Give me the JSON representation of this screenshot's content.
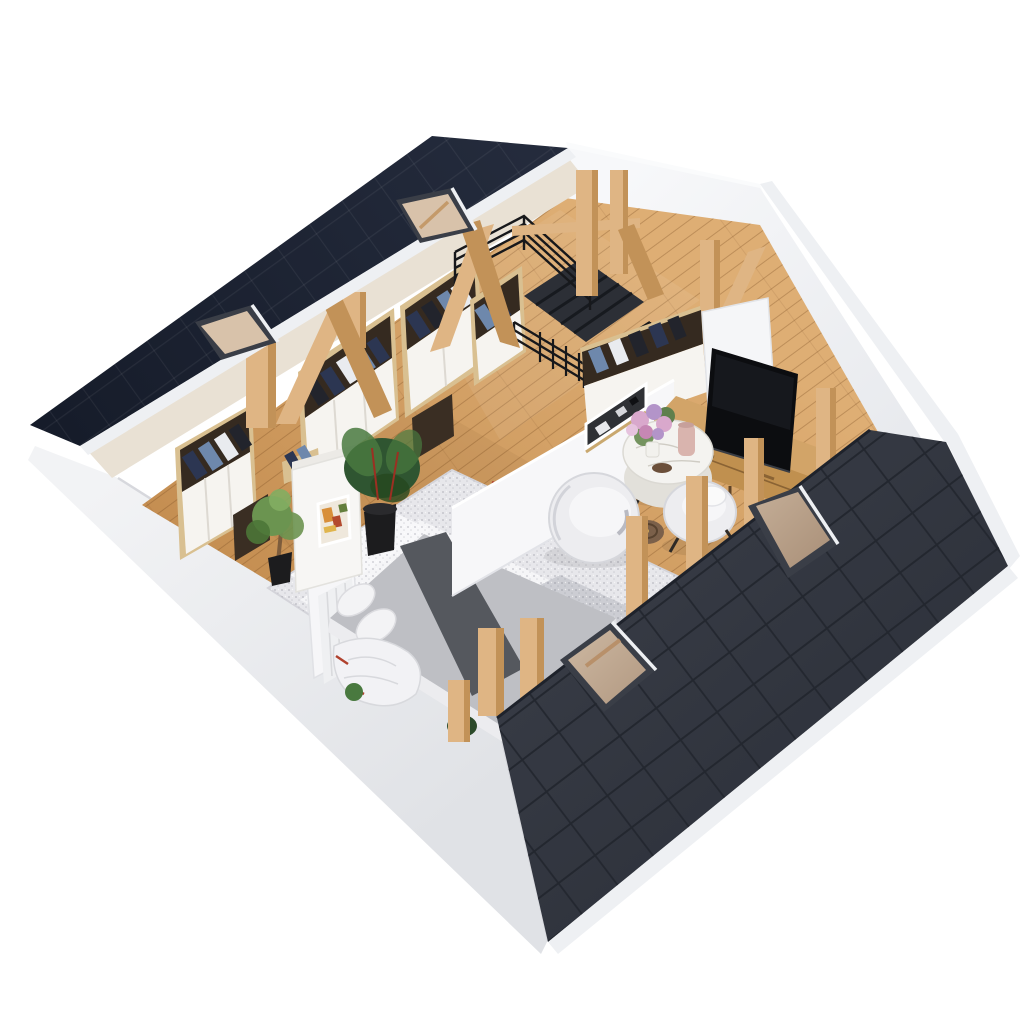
{
  "scene": {
    "label": "3D isometric attic floor plan render with open bedroom and living area under a dark tiled roof",
    "background": "#ffffff"
  },
  "items": {
    "roofs": [
      "upper-tiled-roof",
      "lower-tiled-roof"
    ],
    "upper_roof_skylights": 2,
    "lower_roof_skylights": 2,
    "structure": [
      "exposed-wood-posts",
      "diagonal-braces",
      "white-cut-walls",
      "oak-plank-floor"
    ],
    "stair_landing": [
      "stair-opening",
      "black-metal-railing",
      "stair-treads"
    ],
    "bedroom": [
      "double-bed",
      "gray-duvet",
      "dark-bed-runner",
      "pillows",
      "area-rug",
      "headboard",
      "wardrobes-with-clothes",
      "decor-cabinet-with-artwork",
      "potted-plants"
    ],
    "living_area": [
      "tv",
      "wood-media-console",
      "round-marble-coffee-table",
      "flower-bouquet",
      "pink-vase",
      "swivel-lounge-chair",
      "tub-chair",
      "brown-side-table",
      "room-divider-with-art",
      "open-closet-with-clothes"
    ]
  },
  "palette": {
    "bg": "#ffffff",
    "roofTopA": "#242b3c",
    "roofTopB": "#161c2a",
    "roofTileLine": "rgba(255,255,255,0.06)",
    "roofLowA": "#3a3e48",
    "roofLowB": "#2a2e37",
    "roofLowLine": "#23272f",
    "ridgeLine": "#1e222b",
    "fascia": "#eef0f3",
    "wallBright": "#f5f6f8",
    "wallFace": "#eceef1",
    "wallShade": "#dfe1e6",
    "bandEdge": "#d7d8dd",
    "underRoof": "#e9e1d4",
    "floorA": "#dcab71",
    "floorB": "#bf8547",
    "plank": "rgba(122,76,34,0.33)",
    "beamFace": "#dfb584",
    "beamSide": "#c29258",
    "beamTop": "#f1d8a8",
    "stairPit": "#2c2f36",
    "tread": "#171a1f",
    "rail": "#17181b",
    "wardWood": "#d9c091",
    "wardWoodSide": "#bb8f59",
    "wardWhite": "#f6f4f0",
    "wardSeam": "#ddd9d2",
    "interiorDark": "#352a20",
    "gNavy": "#2c3652",
    "gBlue": "#6e88ac",
    "gWhite": "#e9ebef",
    "gBlack": "#22242c",
    "cabinetDark": "#3a2e23",
    "rugBase": "#e7e7eb",
    "rugLight": "#f6f6f8",
    "rugDark": "#c7c8cf",
    "rugEdge": "#d5d6dc",
    "duvet": "#bebfc4",
    "runner": "#55585e",
    "pillow": "#f3f3f5",
    "mattress": "#ececef",
    "mattressShade": "#e0e1e5",
    "headboard": "#f6f6f8",
    "stripe": "#d9dadd",
    "throw": "#f2f2f5",
    "accentRed": "#b0412e",
    "plantDark": "#2f5531",
    "plantLight": "#49793f",
    "plantPot": "#1c1c1e",
    "treeGreen": "#6b9450",
    "trunk": "#7d5c3c",
    "artBg": "#efe8dc",
    "artOrange": "#d88f3a",
    "artRed": "#b34a2e",
    "artGreen": "#647f3e",
    "artYellow": "#e0b54d",
    "dividerWhite": "#f7f7f9",
    "frameDark": "#2f3135",
    "frameWhite": "#ffffff",
    "artTrim": "#c9a86f",
    "marbleTop": "#f4f3f0",
    "marbleSide": "#e2e0da",
    "tableLeg": "#2e2a26",
    "flowerPinkA": "#d9a8cc",
    "flowerPinkB": "#c687b4",
    "flowerPurple": "#b394c9",
    "flowerLightPink": "#e6c3de",
    "leafGreen": "#74935f",
    "vaseWhite": "#f2f1ed",
    "vasePink": "#d9b4ae",
    "birdBrown": "#6b4f3a",
    "pouf": "#ededf0",
    "poufShade": "#d2d3d9",
    "poufCushion": "#f6f6f8",
    "sideTable": "#7b604a",
    "sideTableRing": "#57422f",
    "tvBlack": "#0c0d10",
    "tvGloss": "#1b1e25",
    "consoleTop": "#d2a468",
    "consoleFront": "#c0904f",
    "consoleSide": "#a67a3f",
    "consoleLine": "#8a6334",
    "glassA": "#d8c2aa",
    "glassB": "#b2977e",
    "skyFrame": "#3a3e47",
    "shadow": "rgba(0,0,0,0.08)"
  }
}
